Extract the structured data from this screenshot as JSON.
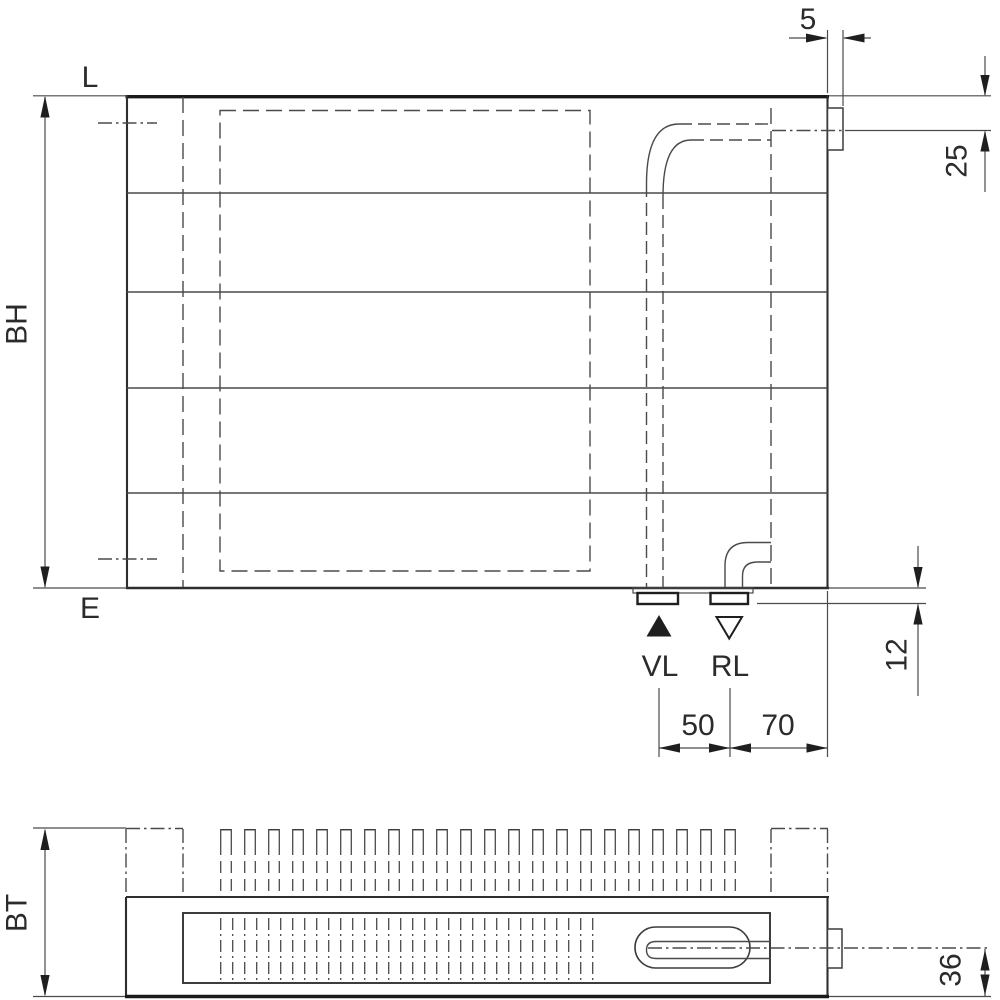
{
  "front_view": {
    "label_top_left": "L",
    "label_bottom_left": "E",
    "dim_height": "BH",
    "dim_tab_width": "5",
    "dim_top_connection_offset": "25",
    "dim_stub_height": "12",
    "dim_vl_to_rl": "50",
    "dim_rl_to_edge": "70",
    "marker_supply": "VL",
    "marker_return": "RL"
  },
  "top_view": {
    "dim_depth": "BT",
    "dim_connection_to_bottom": "36"
  },
  "colors": {
    "line": "#3c3c3c",
    "line_dark": "#1a1a1a",
    "dimension": "#4a4a4a",
    "text": "#2b2b2b",
    "background": "#ffffff"
  }
}
